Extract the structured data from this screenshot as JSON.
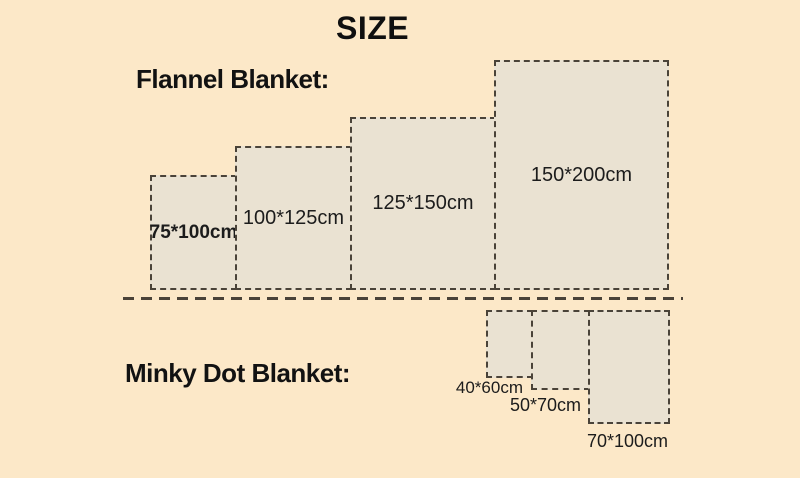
{
  "page": {
    "title": "SIZE"
  },
  "colors": {
    "background": "#fce8c8",
    "rect_fill": "#eae2d2",
    "rect_border": "#4a4339",
    "divider": "#4a4238",
    "text": "#121212"
  },
  "flannel": {
    "heading": "Flannel Blanket:",
    "items": [
      {
        "label": "75*100cm",
        "width_cm": 75,
        "height_cm": 100
      },
      {
        "label": "100*125cm",
        "width_cm": 100,
        "height_cm": 125
      },
      {
        "label": "125*150cm",
        "width_cm": 125,
        "height_cm": 150
      },
      {
        "label": "150*200cm",
        "width_cm": 150,
        "height_cm": 200
      }
    ]
  },
  "minky": {
    "heading": "Minky Dot Blanket:",
    "items": [
      {
        "label": "40*60cm",
        "width_cm": 40,
        "height_cm": 60
      },
      {
        "label": "50*70cm",
        "width_cm": 50,
        "height_cm": 70
      },
      {
        "label": "70*100cm",
        "width_cm": 70,
        "height_cm": 100
      }
    ]
  }
}
